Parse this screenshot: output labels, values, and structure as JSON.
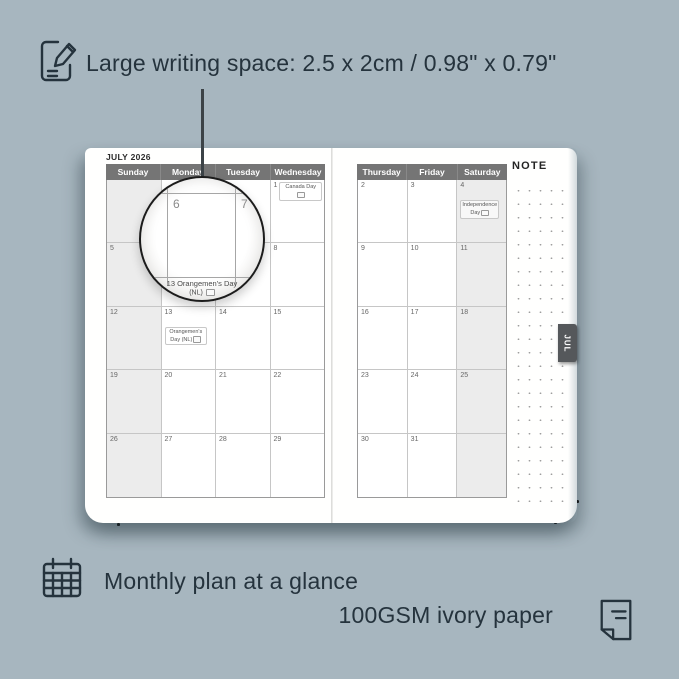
{
  "colors": {
    "background": "#a7b6bf",
    "ink": "#25333d",
    "header_bar": "#757575",
    "weekend_shade": "#ececec",
    "tab_bg": "#55585b",
    "page": "#ffffff"
  },
  "annotations": {
    "top_feature": "Large writing space: 2.5 x 2cm / 0.98\" x 0.79\"",
    "bottom_feature": "Monthly plan at a glance",
    "paper_feature": "100GSM ivory paper"
  },
  "icons": {
    "top": "note-pencil-icon",
    "bottom_left": "calendar-icon",
    "bottom_right": "paper-icon"
  },
  "planner": {
    "month_title": "JULY 2026",
    "note_label": "NOTE",
    "month_tab": "JUL",
    "left_page": {
      "day_headers": [
        "Sunday",
        "Monday",
        "Tuesday",
        "Wednesday"
      ],
      "shaded_columns": [
        0
      ],
      "rows": [
        [
          {
            "d": ""
          },
          {
            "d": ""
          },
          {
            "d": ""
          },
          {
            "d": "1",
            "holiday": "Canada Day",
            "badge": true
          }
        ],
        [
          {
            "d": "5"
          },
          {
            "d": "6"
          },
          {
            "d": "7"
          },
          {
            "d": "8"
          }
        ],
        [
          {
            "d": "12"
          },
          {
            "d": "13",
            "holiday": "Orangemen's Day (NL)",
            "badge": true
          },
          {
            "d": "14"
          },
          {
            "d": "15"
          }
        ],
        [
          {
            "d": "19"
          },
          {
            "d": "20"
          },
          {
            "d": "21"
          },
          {
            "d": "22"
          }
        ],
        [
          {
            "d": "26"
          },
          {
            "d": "27"
          },
          {
            "d": "28"
          },
          {
            "d": "29"
          }
        ]
      ]
    },
    "right_page": {
      "day_headers": [
        "Thursday",
        "Friday",
        "Saturday"
      ],
      "shaded_columns": [
        2
      ],
      "rows": [
        [
          {
            "d": "2"
          },
          {
            "d": "3"
          },
          {
            "d": "4",
            "holiday": "Independence Day",
            "badge": true
          }
        ],
        [
          {
            "d": "9"
          },
          {
            "d": "10"
          },
          {
            "d": "11"
          }
        ],
        [
          {
            "d": "16"
          },
          {
            "d": "17"
          },
          {
            "d": "18"
          }
        ],
        [
          {
            "d": "23"
          },
          {
            "d": "24"
          },
          {
            "d": "25"
          }
        ],
        [
          {
            "d": "30"
          },
          {
            "d": "31"
          },
          {
            "d": ""
          }
        ]
      ]
    },
    "magnifier": {
      "date_left": "6",
      "date_right": "7",
      "holiday_line1": "13   Orangemen's Day",
      "holiday_line2": "(NL)"
    }
  }
}
